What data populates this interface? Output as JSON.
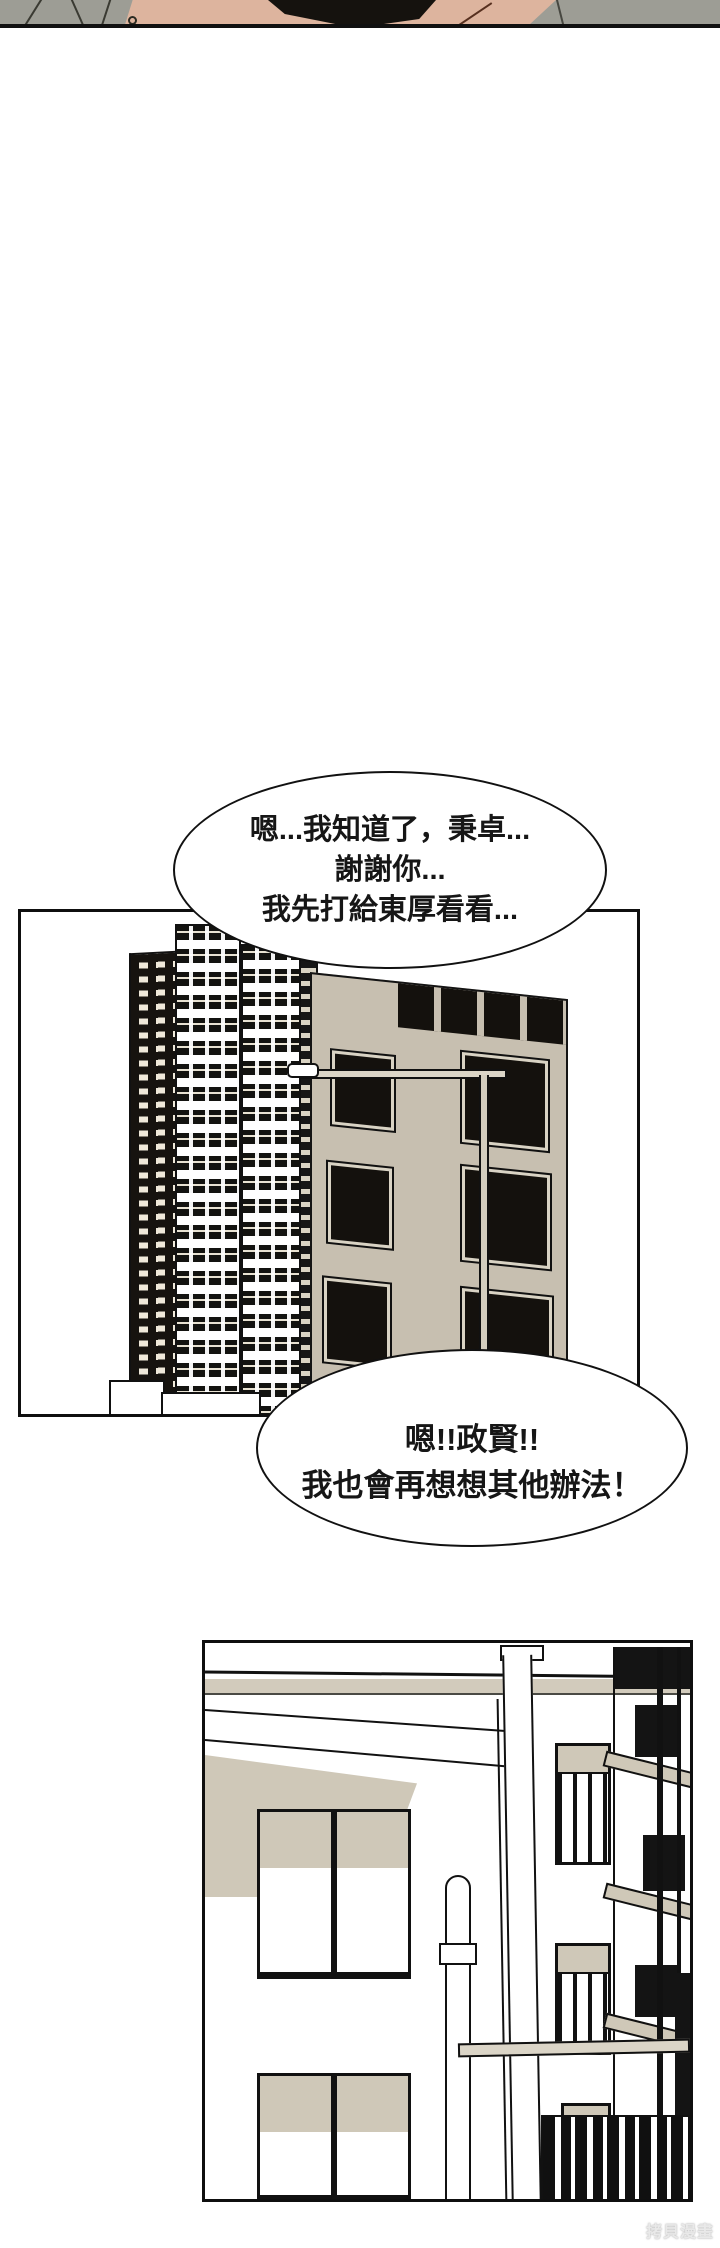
{
  "comic": {
    "bubble1": {
      "line1": "嗯...我知道了，秉卓...",
      "line2": "謝謝你...",
      "line3": "我先打給東厚看看..."
    },
    "bubble2": {
      "line1": "嗯!!政賢!!",
      "line2": "我也會再想想其他辦法！"
    },
    "watermark": "拷貝漫畫"
  },
  "colors": {
    "ink": "#111111",
    "paper": "#ffffff",
    "beige_building": "#c7bfb0",
    "beige_shading": "#cfc8b8",
    "beige_strip": "#d2cbbc",
    "clothing_gray": "#9d9d95",
    "skin": "#ddb49e",
    "hair_black": "#15120e",
    "watermark_gray": "#c9c9c9"
  }
}
